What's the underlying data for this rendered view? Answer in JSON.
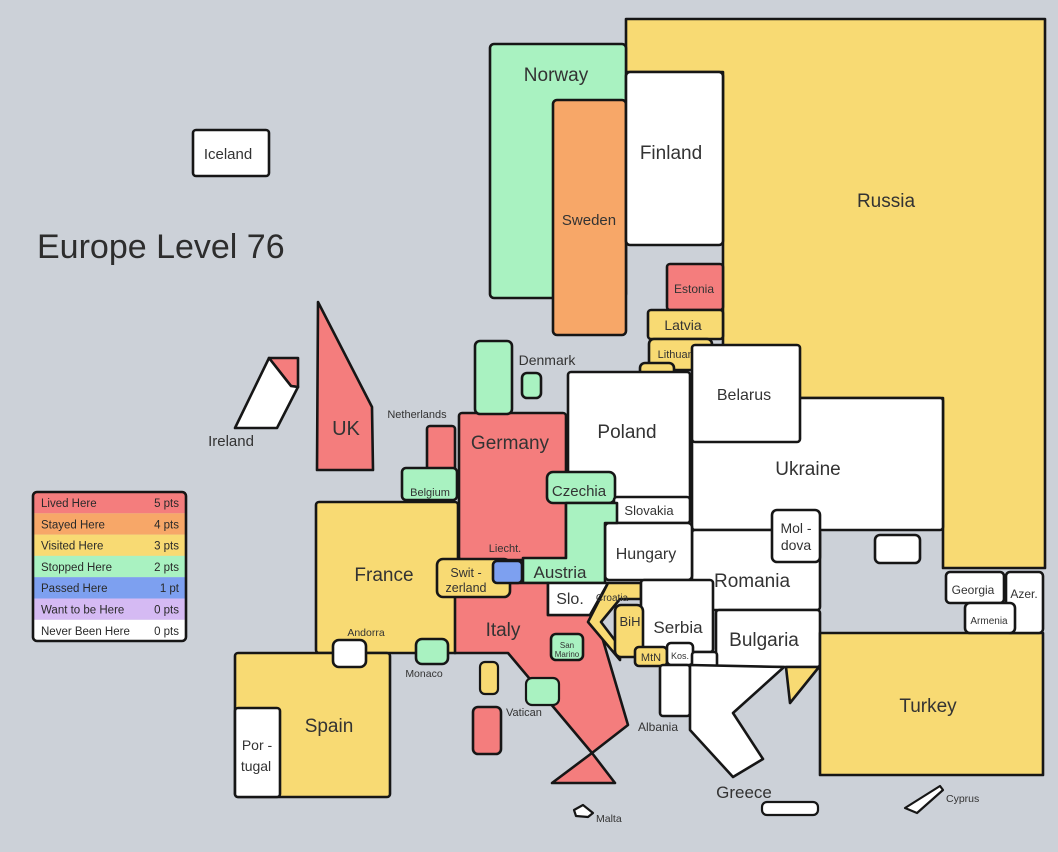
{
  "title": "Europe Level 76",
  "colors": {
    "sea": "#ccd1d8",
    "border": "#161616",
    "label_text": "#333333",
    "lived": "#f47d7d",
    "stayed": "#f7a768",
    "visited": "#f8da73",
    "stopped": "#a9f2c1",
    "passed": "#7da0f0",
    "want": "#d5baf3",
    "never": "#ffffff"
  },
  "legend": {
    "items": [
      {
        "label": "Lived Here",
        "points": "5 pts"
      },
      {
        "label": "Stayed Here",
        "points": "4 pts"
      },
      {
        "label": "Visited Here",
        "points": "3 pts"
      },
      {
        "label": "Stopped Here",
        "points": "2 pts"
      },
      {
        "label": "Passed Here",
        "points": "1 pt"
      },
      {
        "label": "Want to be Here",
        "points": "0 pts"
      },
      {
        "label": "Never Been Here",
        "points": "0 pts"
      }
    ]
  },
  "countries": {
    "iceland": {
      "label": "Iceland"
    },
    "norway": {
      "label": "Norway"
    },
    "sweden": {
      "label": "Sweden"
    },
    "finland": {
      "label": "Finland"
    },
    "russia": {
      "label": "Russia"
    },
    "uk": {
      "label": "UK"
    },
    "ireland": {
      "label": "Ireland"
    },
    "estonia": {
      "label": "Estonia"
    },
    "latvia": {
      "label": "Latvia"
    },
    "lithuania": {
      "label": "Lithuania"
    },
    "poland": {
      "label": "Poland"
    },
    "belarus": {
      "label": "Belarus"
    },
    "ukraine": {
      "label": "Ukraine"
    },
    "moldova": {
      "label": "Mol -",
      "label2": "dova"
    },
    "romania": {
      "label": "Romania"
    },
    "bulgaria": {
      "label": "Bulgaria"
    },
    "georgia": {
      "label": "Georgia"
    },
    "azerbaijan": {
      "label": "Azer."
    },
    "armenia": {
      "label": "Armenia"
    },
    "turkey": {
      "label": "Turkey"
    },
    "germany": {
      "label": "Germany"
    },
    "netherlands": {
      "label": "Netherlands"
    },
    "denmark": {
      "label": "Denmark"
    },
    "belgium": {
      "label": "Belgium"
    },
    "luxembourg": {
      "label": "Lux."
    },
    "france": {
      "label": "France"
    },
    "czechia": {
      "label": "Czechia"
    },
    "slovakia": {
      "label": "Slovakia"
    },
    "hungary": {
      "label": "Hungary"
    },
    "austria": {
      "label": "Austria"
    },
    "switzerland": {
      "label": "Swit -",
      "label2": "zerland"
    },
    "liechtenstein": {
      "label": "Liecht."
    },
    "italy": {
      "label": "Italy"
    },
    "slovenia": {
      "label": "Slo."
    },
    "croatia": {
      "label": "Croatia"
    },
    "bih": {
      "label": "BiH"
    },
    "serbia": {
      "label": "Serbia"
    },
    "montenegro": {
      "label": "MtN"
    },
    "kosovo": {
      "label": "Kos."
    },
    "macedonia": {
      "label": "Mac."
    },
    "albania": {
      "label": "Albania"
    },
    "greece": {
      "label": "Greece"
    },
    "cyprus": {
      "label": "Cyprus"
    },
    "malta": {
      "label": "Malta"
    },
    "spain": {
      "label": "Spain"
    },
    "portugal": {
      "label": "Por -",
      "label2": "tugal"
    },
    "andorra": {
      "label": "Andorra"
    },
    "monaco": {
      "label": "Monaco"
    },
    "san_marino": {
      "label": "San",
      "label2": "Marino"
    },
    "vatican": {
      "label": "Vatican"
    }
  }
}
